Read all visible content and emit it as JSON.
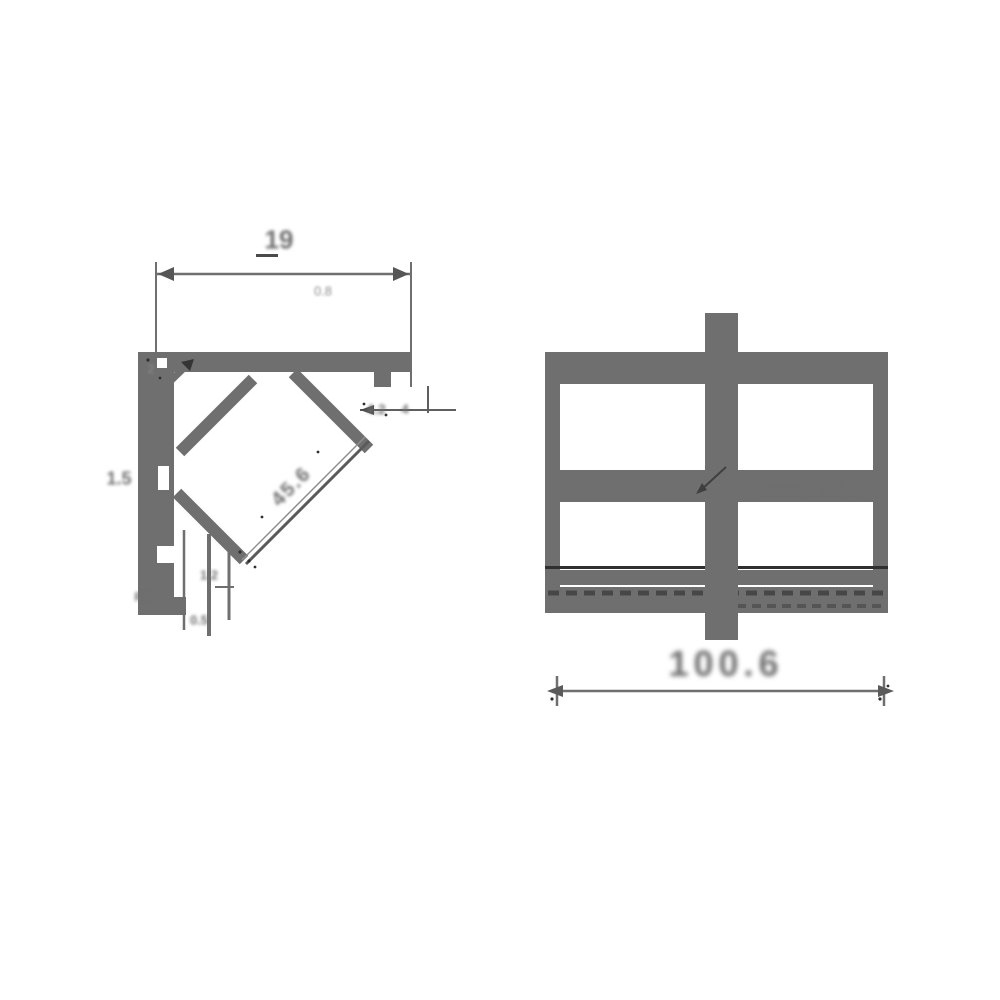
{
  "sheet": {
    "background": "#ffffff",
    "ink_color": "#6f6f6f",
    "dark_ink_color": "#3a3a3a",
    "description": "Technical drawing with two aluminum profile cross-sections"
  },
  "left_view": {
    "name": "45-degree corner profile section",
    "labels": {
      "width_dim": "19",
      "sub_dim": "0.8",
      "corner_note": "2",
      "side_thickness": "1.5",
      "lip_dim_a": "4.2",
      "lip_dim_b": "4",
      "channel_dim": "45.6",
      "bottom_dim_a": "1.2",
      "bottom_dim_b": "8",
      "radius_note": "R1",
      "foot_dim": "0.5"
    }
  },
  "right_view": {
    "name": "rectangular profile section with center bar",
    "labels": {
      "bar_note": "4.5",
      "band_text": "oooo ALU",
      "overall_dim": "100.6"
    }
  }
}
